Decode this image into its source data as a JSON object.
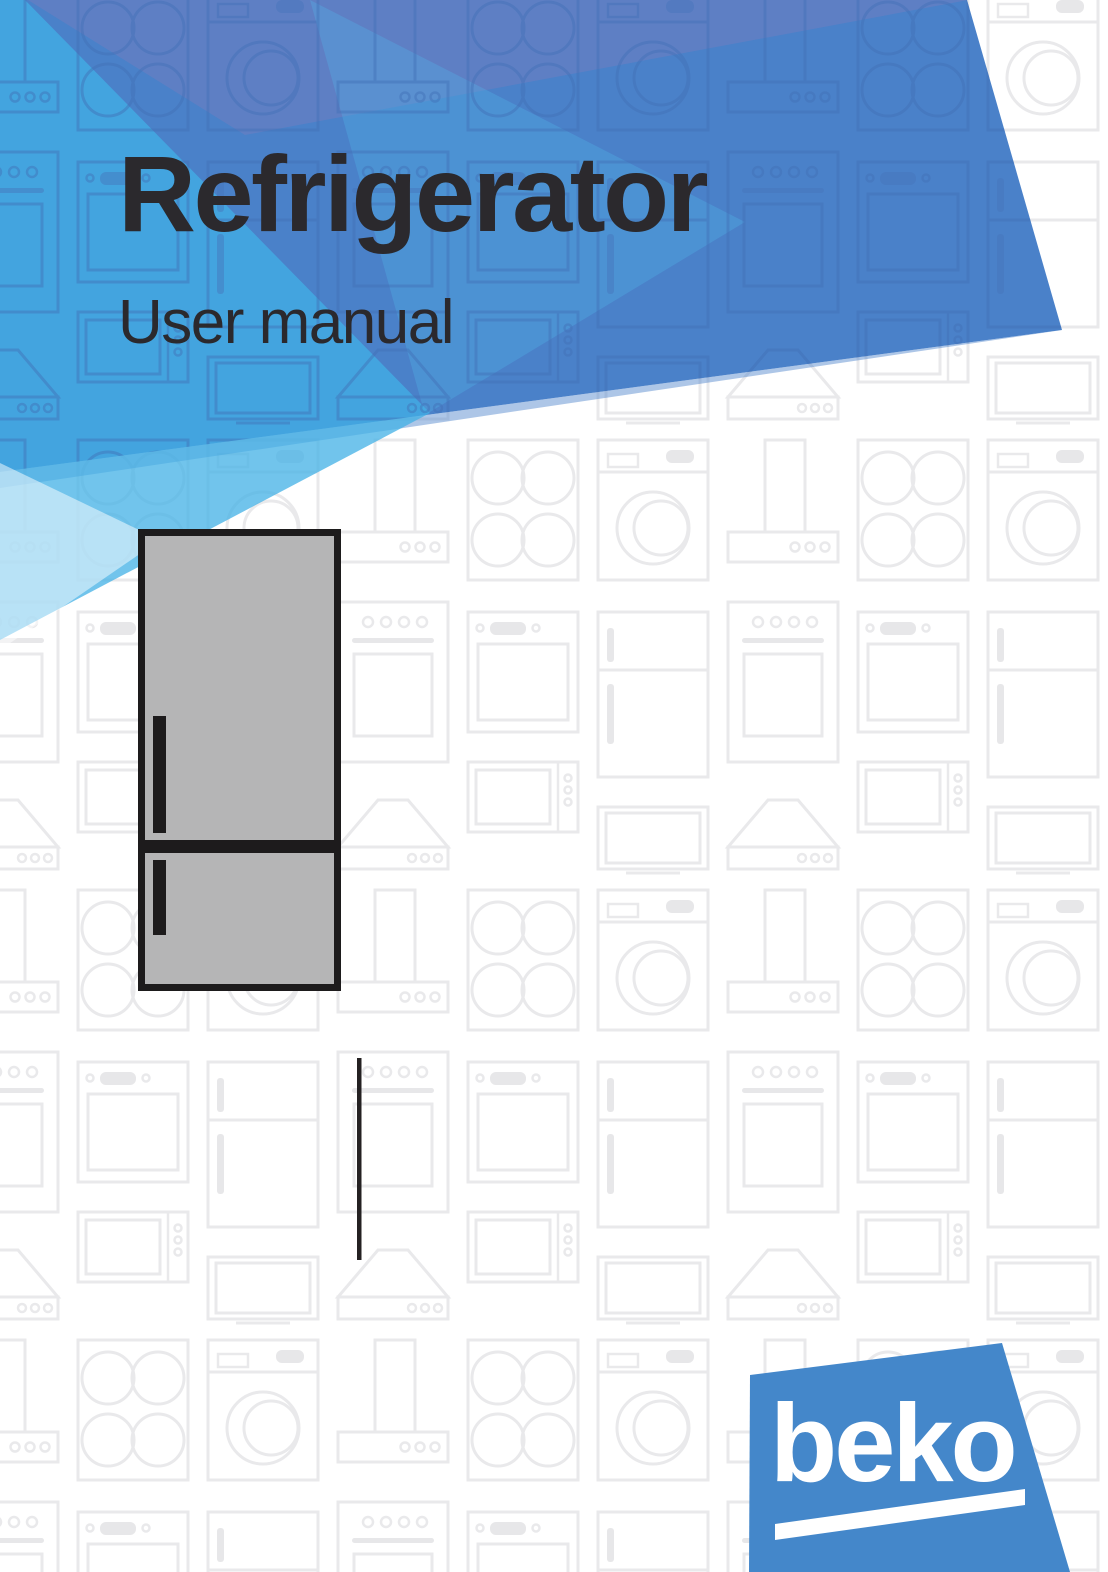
{
  "page": {
    "title": "Refrigerator",
    "subtitle": "User manual",
    "title_color": "#2b292d"
  },
  "logo": {
    "brand": "beko",
    "background_color": "#4487ca",
    "text_color": "#ffffff"
  },
  "artwork": {
    "colors": {
      "main_blue": "#4a81c9",
      "navy_overlay": "#6d7fc1",
      "bright_cyan": "#41b0e5",
      "pale_cyan": "#a9d7ef",
      "pattern_line_gray": "#e9e9eb",
      "pattern_line_blue": "#3f6fb5"
    },
    "pattern_icons": [
      "washing-machine-icon",
      "oven-icon",
      "cooktop-icon",
      "range-hood-icon",
      "microwave-icon",
      "tv-icon",
      "refrigerator-icon"
    ]
  },
  "illustration": {
    "name": "bottom-freezer-refrigerator",
    "body_color": "#b5b5b6",
    "outline_color": "#1d1b1c"
  }
}
